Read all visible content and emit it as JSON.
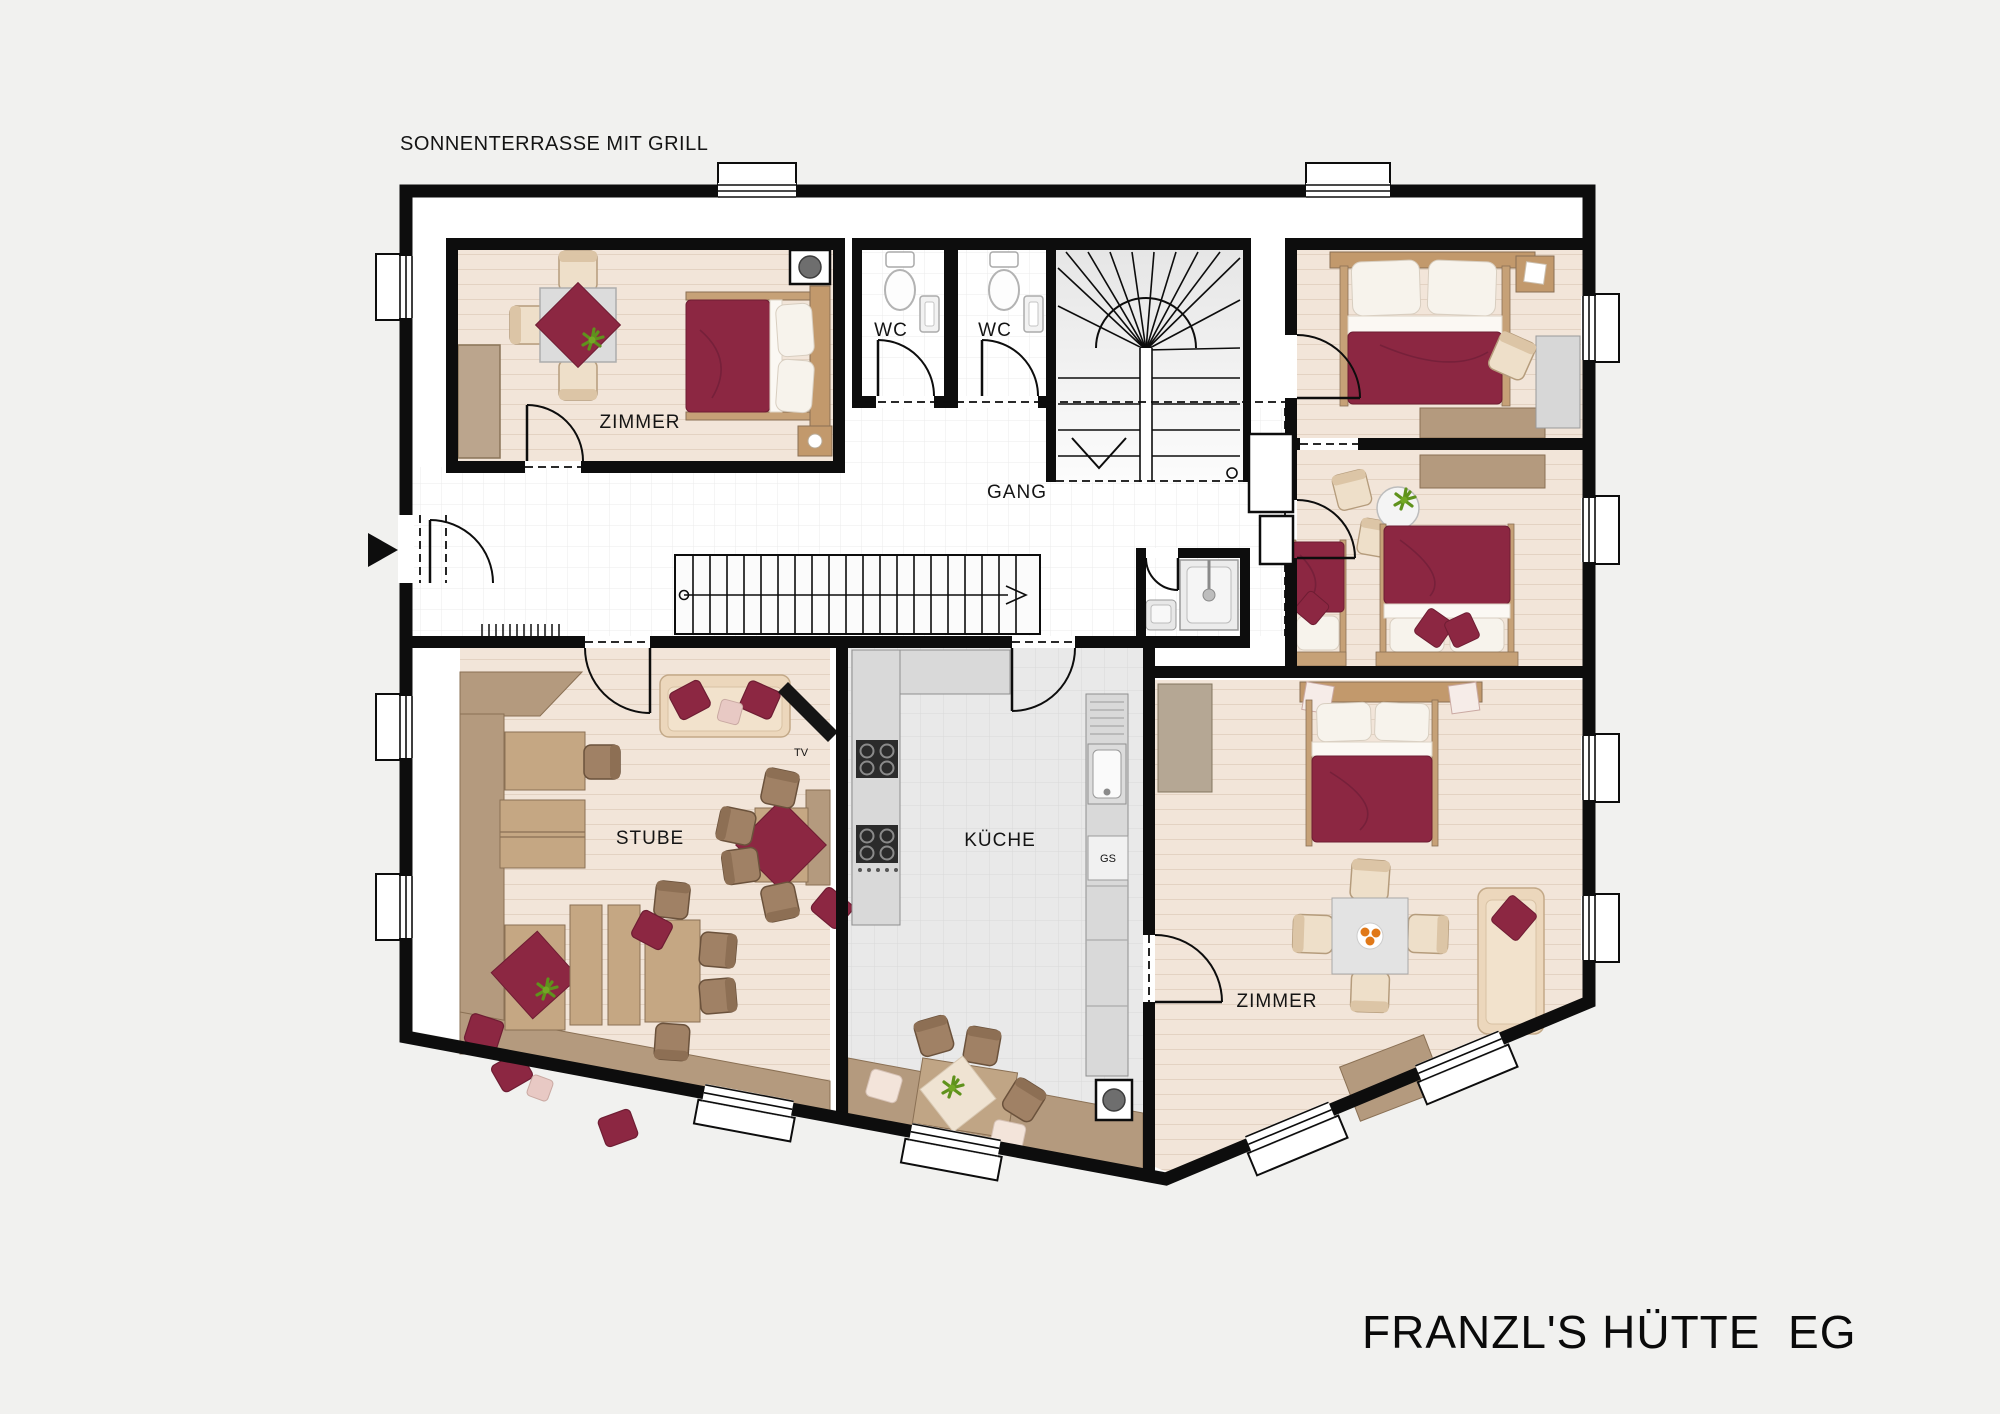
{
  "title": "FRANZL'S HÜTTE  EG",
  "annotations": {
    "terrace": "SONNENTERRASSE MIT GRILL"
  },
  "rooms": {
    "bedroom_top_left": {
      "label": "ZIMMER"
    },
    "wc_left": {
      "label": "WC"
    },
    "wc_right": {
      "label": "WC"
    },
    "hallway": {
      "label": "GANG"
    },
    "living_room": {
      "label": "STUBE"
    },
    "kitchen": {
      "label": "KÜCHE"
    },
    "bedroom_bottom_right": {
      "label": "ZIMMER"
    }
  },
  "appliances": {
    "tv": "TV",
    "dishwasher": "GS"
  },
  "colors": {
    "background": "#f1f1ef",
    "wall": "#0d0d0d",
    "floor_wood": "#f2e5d9",
    "floor_tile": "#e9e9e9",
    "furniture_tan": "#c5a783",
    "bench_tan": "#b49a7e",
    "accent_maroon": "#8c2742",
    "bedding_white": "#f8f4ee"
  }
}
